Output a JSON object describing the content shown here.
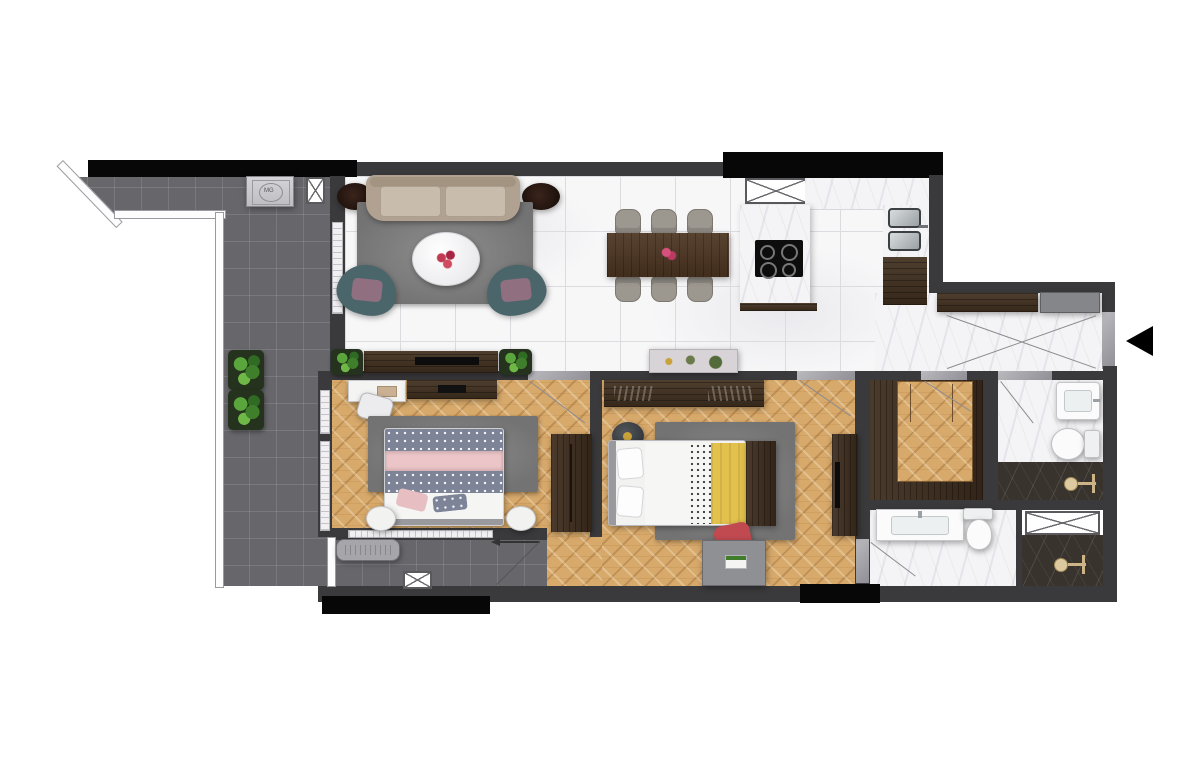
{
  "meta": {
    "type": "apartment-floor-plan",
    "view": "top-down"
  },
  "labels": {
    "washer": "MG"
  },
  "icons": {
    "entrance": "left-arrow-entrance-marker"
  },
  "colors": {
    "wall": "#3a3a3c",
    "wall_black": "#070707",
    "marble_floor": "#f7f7f8",
    "hall_marble": "#f4f4f6",
    "balcony_tile": "#67676b",
    "wood_floor": "#d7a96b",
    "dark_wood": "#41301f",
    "shower_marble": "#39332e",
    "rug": "#7f7f7f",
    "sofa": "#b3a493",
    "armchair_teal": "#4a666a",
    "bed1_pink": "#ebc5c8",
    "bed1_dots": "#7d8497",
    "bed2_yellow": "#e2c14d",
    "desk_chair_red": "#c04a50",
    "fixture_brass": "#dcc9a0",
    "entrance_arrow": "#000000"
  },
  "rooms": [
    {
      "name": "balcony-terrace"
    },
    {
      "name": "living-room"
    },
    {
      "name": "dining-area"
    },
    {
      "name": "kitchen"
    },
    {
      "name": "entry-hall"
    },
    {
      "name": "bedroom-1"
    },
    {
      "name": "bedroom-2"
    },
    {
      "name": "walk-in-closet"
    },
    {
      "name": "bathroom-1"
    },
    {
      "name": "bathroom-2"
    },
    {
      "name": "loggia"
    }
  ]
}
